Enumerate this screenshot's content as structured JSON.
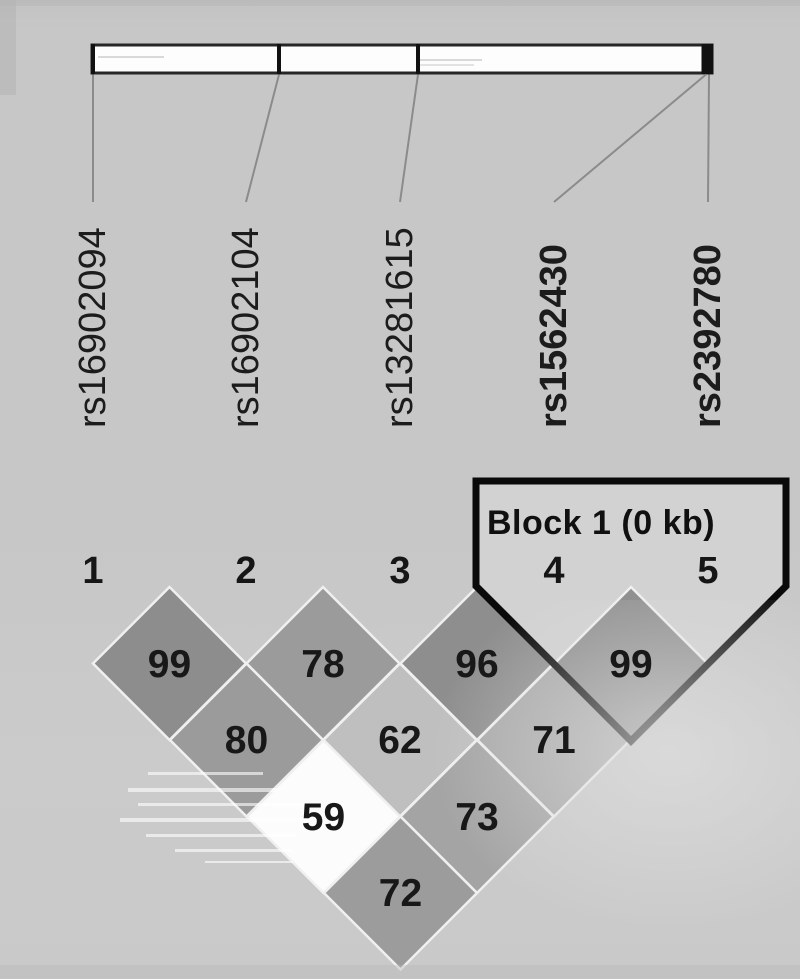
{
  "chart_data": {
    "type": "heatmap",
    "subtype": "linkage-disequilibrium-plot",
    "title": "",
    "block": {
      "label": "Block 1 (0 kb)",
      "snps": [
        4,
        5
      ],
      "size_kb": "0 kb"
    },
    "snps": [
      {
        "index": "1",
        "id": "rs16902094",
        "bold": false,
        "bar_x": 93,
        "label_x": 93,
        "tick_w": 4
      },
      {
        "index": "2",
        "id": "rs16902104",
        "bold": false,
        "bar_x": 279,
        "label_x": 246,
        "tick_w": 4
      },
      {
        "index": "3",
        "id": "rs13281615",
        "bold": false,
        "bar_x": 418,
        "label_x": 400,
        "tick_w": 4
      },
      {
        "index": "4",
        "id": "rs1562430",
        "bold": true,
        "bar_x": 706,
        "label_x": 554,
        "tick_w": 9
      },
      {
        "index": "5",
        "id": "rs2392780",
        "bold": true,
        "bar_x": 709,
        "label_x": 708,
        "tick_w": 9
      }
    ],
    "pairs": [
      {
        "a": 1,
        "b": 2,
        "value": "99",
        "fill": "#8d8d8d"
      },
      {
        "a": 2,
        "b": 3,
        "value": "78",
        "fill": "#9b9b9b"
      },
      {
        "a": 3,
        "b": 4,
        "value": "96",
        "fill": "#8e8e8e"
      },
      {
        "a": 4,
        "b": 5,
        "value": "99",
        "fill": "#909090"
      },
      {
        "a": 1,
        "b": 3,
        "value": "80",
        "fill": "#9b9b9b"
      },
      {
        "a": 2,
        "b": 4,
        "value": "62",
        "fill": "#bfbfbf"
      },
      {
        "a": 3,
        "b": 5,
        "value": "71",
        "fill": "#a9a9a9"
      },
      {
        "a": 1,
        "b": 4,
        "value": "59",
        "fill": "#fcfcfc"
      },
      {
        "a": 2,
        "b": 5,
        "value": "73",
        "fill": "#a4a4a4"
      },
      {
        "a": 1,
        "b": 5,
        "value": "72",
        "fill": "#9c9c9c"
      }
    ],
    "colors": {
      "background": "#c7c7c7",
      "bar_fill": "#fdfdfd",
      "bar_border": "#262626",
      "tick": "#111111",
      "connector_line": "#8b8b8b",
      "block_fill": "#d2d2d2",
      "block_outline": "#0a0a0a",
      "diamond_gap": "#f0f0f0",
      "text": "#181818"
    }
  }
}
